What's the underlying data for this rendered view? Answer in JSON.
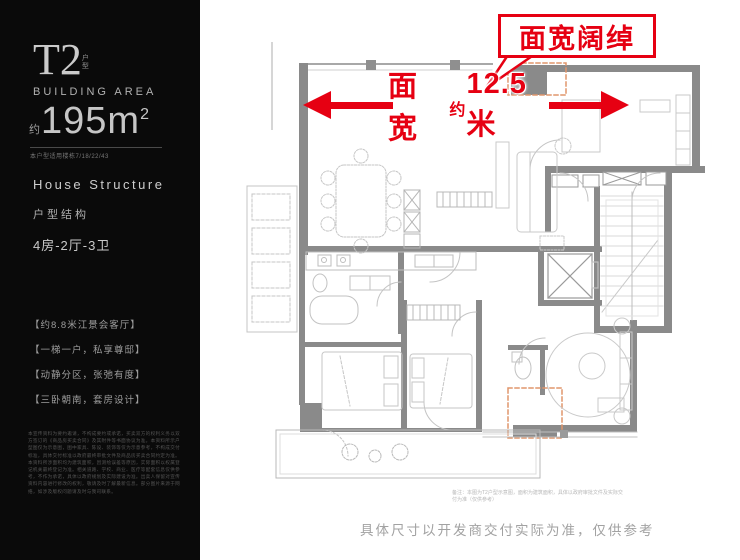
{
  "sidebar": {
    "unit_code": "T2",
    "unit_suffix": "户型",
    "area_label_en": "BUILDING AREA",
    "area_prefix": "约",
    "area_value": "195m",
    "area_sup": "2",
    "applicable_note": "本户型适用楼栋7/18/22/43",
    "structure_en": "House Structure",
    "structure_cn": "户型结构",
    "layout": "4房-2厅-3卫",
    "highlights": [
      "【约8.8米江景会客厅】",
      "【一梯一户，私享尊邸】",
      "【动静分区，张弛有度】",
      "【三卧朝南，套房设计】"
    ],
    "fine_print": "本宣传资料为要约邀请，不构成要约或承诺，买卖双方的权利义务以双方签订的《商品房买卖合同》及其附件等书面协议为准。本资料所示户型图仅为示意图，图中家具、陈设、装饰等仅为示意参考，不构成交付标准，具体交付标准以政府最终审批文件及商品房买卖合同约定为准。本资料所涉面积均为建筑面积，因测绘误差等原因，实际面积以权属登记机关最终登记为准。相关道路、学校、商业、医疗等配套信息仅供参考，不作为承诺，具体以政府规划及实际建设为准。出卖人保留对宣传资料内容进行修改的权利，敬请及时了解最新信息。部分图片来源于网络，如涉及版权问题请及时与我司联系。"
  },
  "plan": {
    "callout": "面宽阔绰",
    "dim_prefix": "面宽",
    "dim_approx": "约",
    "dim_value": "12.5米",
    "caption": "备注：本图为T2户型示意图，面积为建筑面积，具体以政府审批文件及实际交付为准（仅供参考）",
    "footer_note": "具体尺寸以开发商交付实际为准，仅供参考"
  },
  "colors": {
    "accent_red": "#e60012",
    "wall_gray": "#8a8a8a",
    "sidebar_bg": "#0a0a0a",
    "dashed_orange": "#e0956b"
  }
}
